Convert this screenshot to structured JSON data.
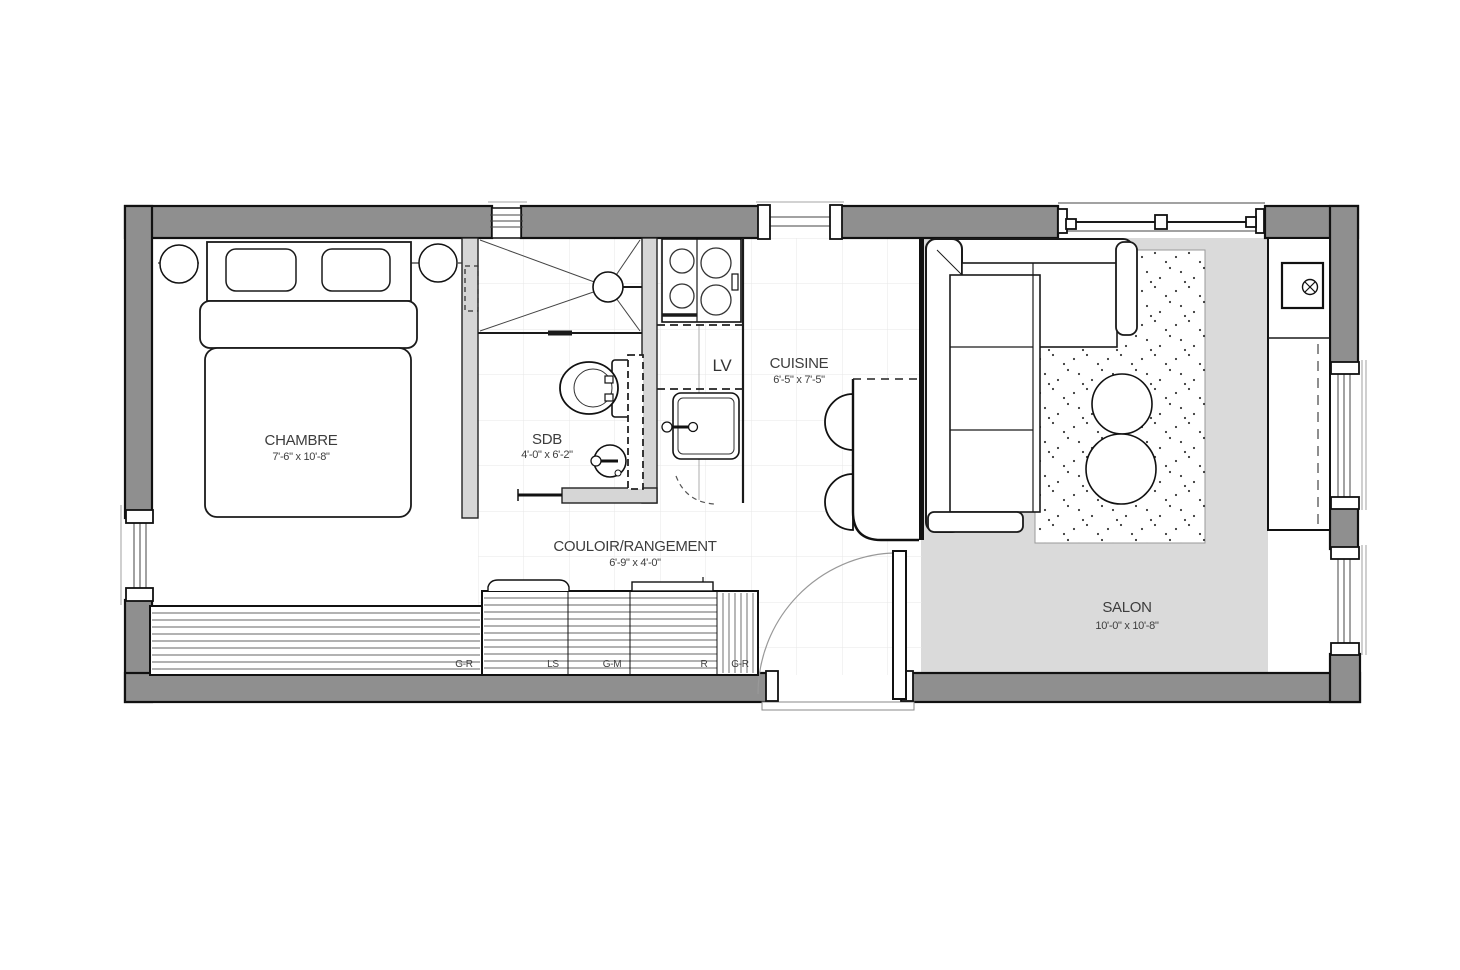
{
  "plan_type": "floor-plan",
  "rooms": [
    {
      "name": "CHAMBRE",
      "dims": "7'-6\" x 10'-8\""
    },
    {
      "name": "SDB",
      "dims": "4'-0\" x 6'-2\""
    },
    {
      "name": "COULOIR/RANGEMENT",
      "dims": "6'-9\" x 4'-0\""
    },
    {
      "name": "CUISINE",
      "dims": "6'-5\" x 7'-5\""
    },
    {
      "name": "SALON",
      "dims": "10'-0\" x 10'-8\""
    }
  ],
  "appliances": {
    "dishwasher_label": "LV"
  },
  "storage": {
    "sections": [
      "G-R",
      "LS",
      "G-M",
      "R",
      "G-R"
    ]
  },
  "colors": {
    "exterior_wall": "#8f8f8f",
    "partition_wall": "#d6d6d6",
    "salon_floor": "#dadada",
    "outline": "#1a1a1a",
    "grid_line": "#e7e7e7",
    "label_text": "#3d3d3d"
  }
}
